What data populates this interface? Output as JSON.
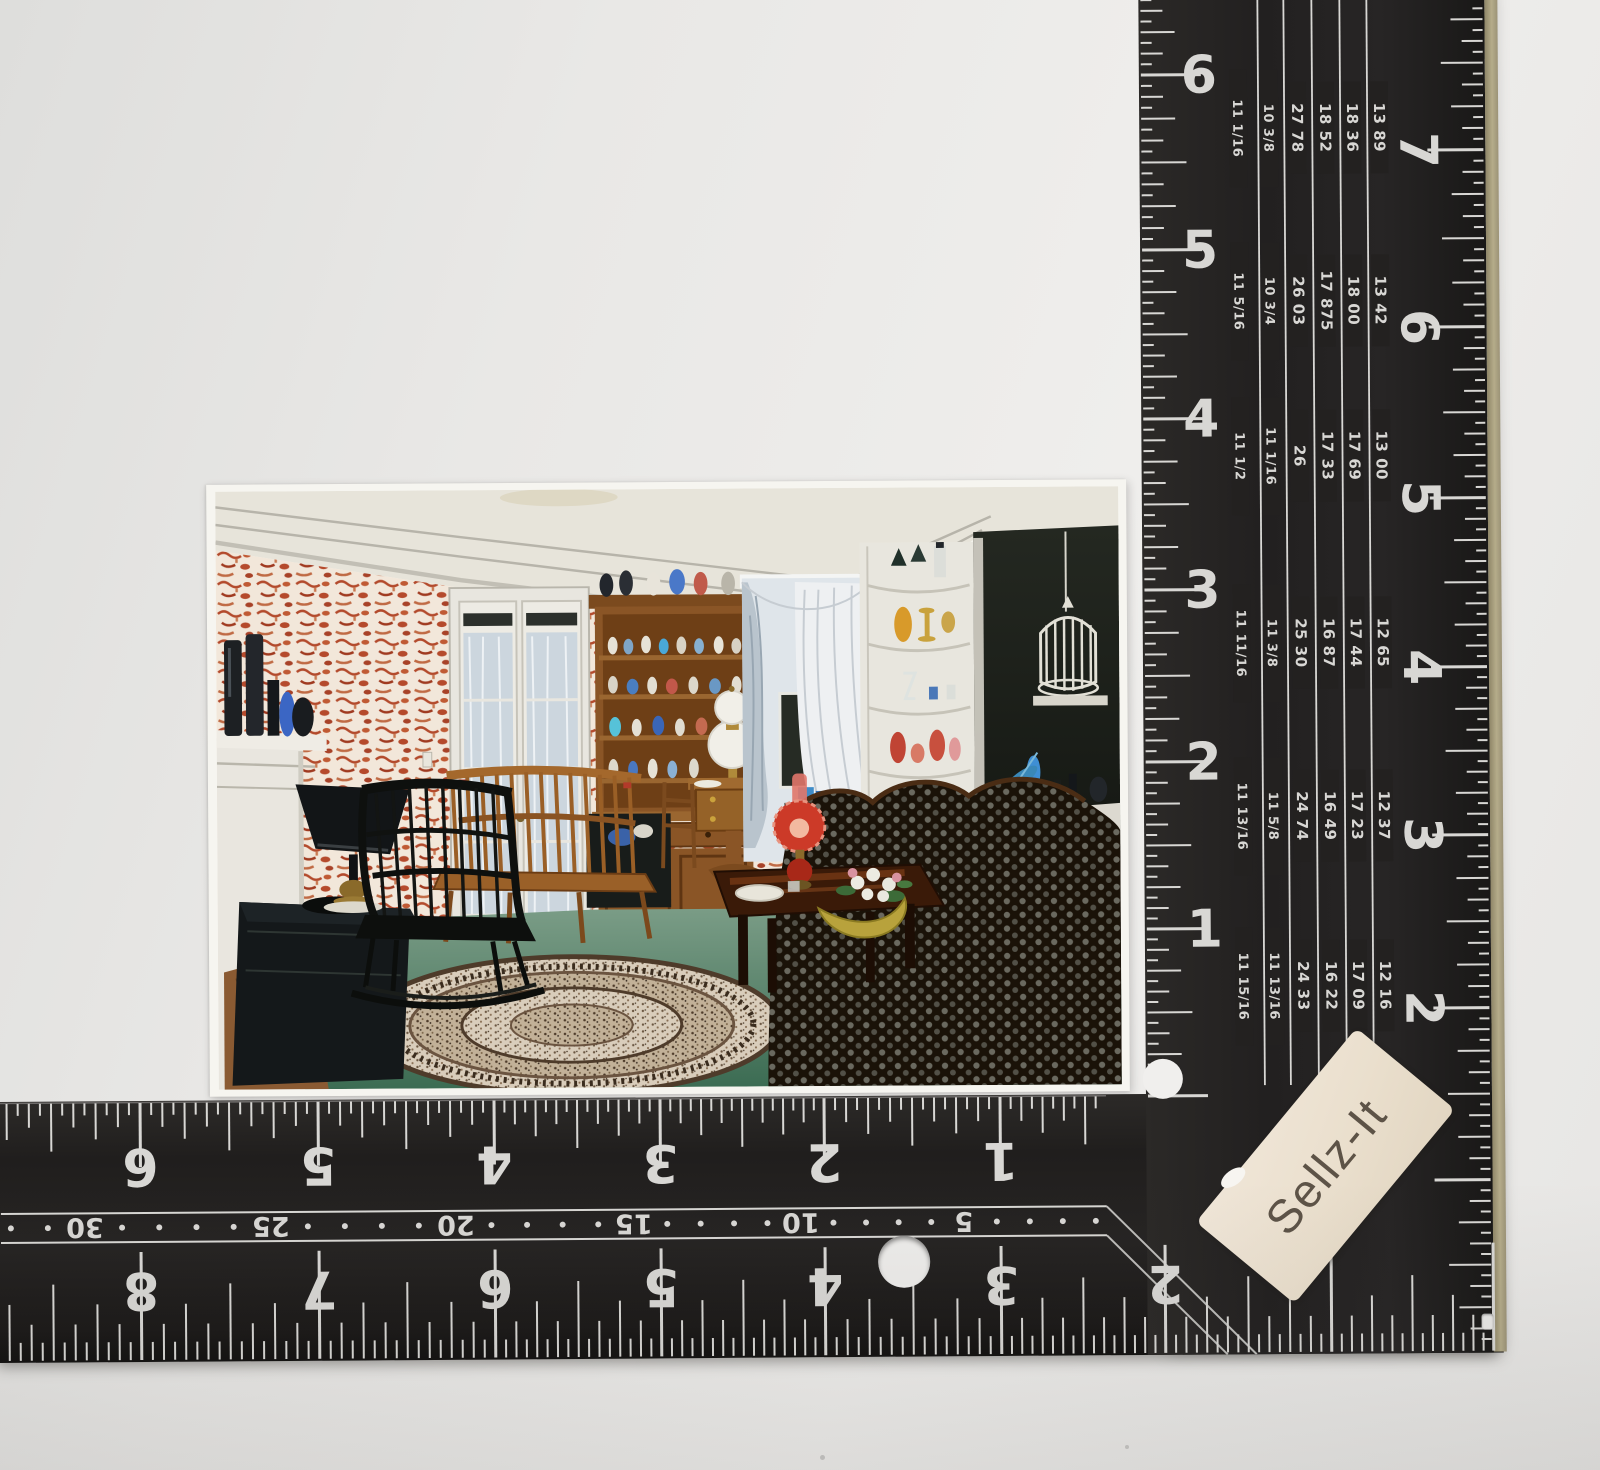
{
  "scene": {
    "background_color": "#e9e8e6",
    "subject": "vintage living-room interior postcard measured with a black L-square ruler"
  },
  "sticker": {
    "text": "Sellz-It",
    "background": "#eadfcd",
    "text_color": "#5d5347"
  },
  "square": {
    "body_color": "#232120",
    "mark_color": "#d8d7d4",
    "edge_color": "#aba283",
    "vertical": {
      "outer_numbers": [
        "6",
        "5",
        "4",
        "3",
        "2",
        "1"
      ],
      "inner_numbers": [
        "8",
        "7",
        "6",
        "5",
        "4",
        "3",
        "2"
      ],
      "scale_rows": [
        [
          "11 1/16",
          "10 3/8",
          "27 78",
          "18 52",
          "18 36",
          "13 89"
        ],
        [
          "11 5/16",
          "10 3/4",
          "26 03",
          "17 875",
          "18 00",
          "13 42"
        ],
        [
          "11 1/2",
          "11 1/16",
          "26",
          "17 33",
          "17 69",
          "13 00"
        ],
        [
          "11 11/16",
          "11 3/8",
          "25 30",
          "16 87",
          "17 44",
          "12 65"
        ],
        [
          "11 13/16",
          "11 5/8",
          "24 74",
          "16 49",
          "17 23",
          "12 37"
        ],
        [
          "11 15/16",
          "11 13/16",
          "24 33",
          "16 22",
          "17 09",
          "12 16"
        ]
      ]
    },
    "horizontal": {
      "top_numbers": [
        "6",
        "5",
        "4",
        "3",
        "2",
        "1"
      ],
      "strip_numbers": [
        "30",
        "25",
        "20",
        "15",
        "10",
        "5"
      ],
      "bottom_numbers": [
        "8",
        "7",
        "6",
        "5",
        "4",
        "3",
        "2"
      ]
    }
  },
  "postcard": {
    "palette": {
      "wallpaper_red": "#b34a2c",
      "carpet_green": "#4c7a60",
      "wood": "#8a5526",
      "sofa_dark": "#191208",
      "white_trim": "#e9e6df"
    }
  }
}
